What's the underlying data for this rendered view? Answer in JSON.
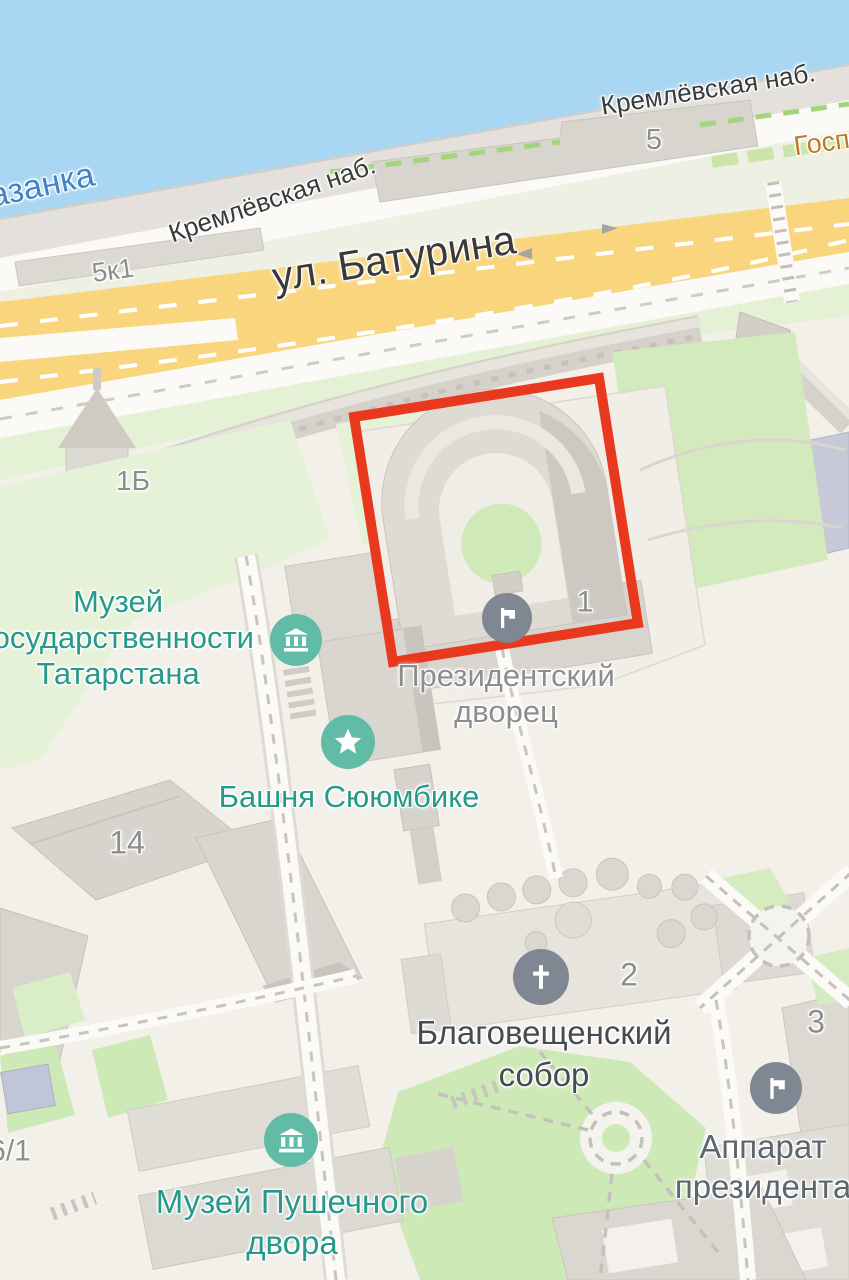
{
  "map": {
    "river_label": "азанка",
    "street_labels": {
      "embankment_west": "Кремлёвская наб.",
      "embankment_east": "Кремлёвская наб.",
      "baturina": "ул. Батурина"
    },
    "poi": {
      "gospozha": "Госпож",
      "museum_gos": [
        "Музей",
        "государственности",
        "Татарстана"
      ],
      "palace": [
        "Президентский",
        "дворец"
      ],
      "syuyumbike": "Башня Сююмбике",
      "cathedral": [
        "Благовещенский",
        "собор"
      ],
      "apparatus": [
        "Аппарат",
        "президента"
      ],
      "cannon_museum": [
        "Музей Пушечного",
        "двора"
      ]
    },
    "numbers": {
      "n5k1": "5к1",
      "n5": "5",
      "n1b": "1Б",
      "n1": "1",
      "n14": "14",
      "n2": "2",
      "n3": "3",
      "n61": "6/1"
    },
    "icons": {
      "museum_gos": "museum-icon",
      "syuyumbike": "star-icon",
      "palace": "flag-icon",
      "cathedral": "cross-icon",
      "apparatus": "flag-icon",
      "cannon_museum": "museum-icon"
    },
    "colors": {
      "highlight_red": "#e8391f",
      "poi_teal": "#60bca6",
      "poi_teal_text": "#27998a",
      "poi_gray": "#7f8892",
      "water": "#a9d6f2",
      "water_text": "#4285c7",
      "road_yellow": "#f9d67e",
      "street_text": "#3a3a3a",
      "number_text": "#8d8d8d",
      "orange_poi_text": "#bb7b27"
    }
  }
}
